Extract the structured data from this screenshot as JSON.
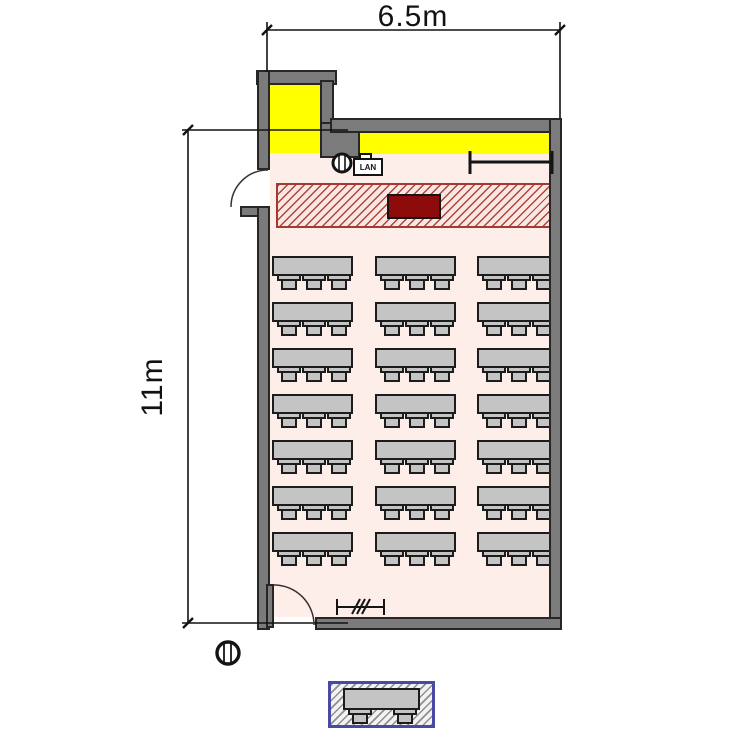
{
  "drawing": {
    "width_dimension": "6.5m",
    "height_dimension": "11m",
    "lan_label": "LAN"
  },
  "room": {
    "desk_rows": 7,
    "desk_columns": 3,
    "seats_per_desk": 3,
    "total_desks": 21,
    "legend_seats_per_desk": 2
  },
  "colors": {
    "wall": "#7b7b7b",
    "floor": "#fdeeea",
    "whiteboard_yellow": "#ffff00",
    "platform_fill": "#f8e7e3",
    "platform_hatch": "#b2423a",
    "lectern": "#8e0b0b",
    "furniture": "#c4c4c4",
    "outline": "#1c1c1c",
    "legend_border": "#4a4aa5"
  }
}
